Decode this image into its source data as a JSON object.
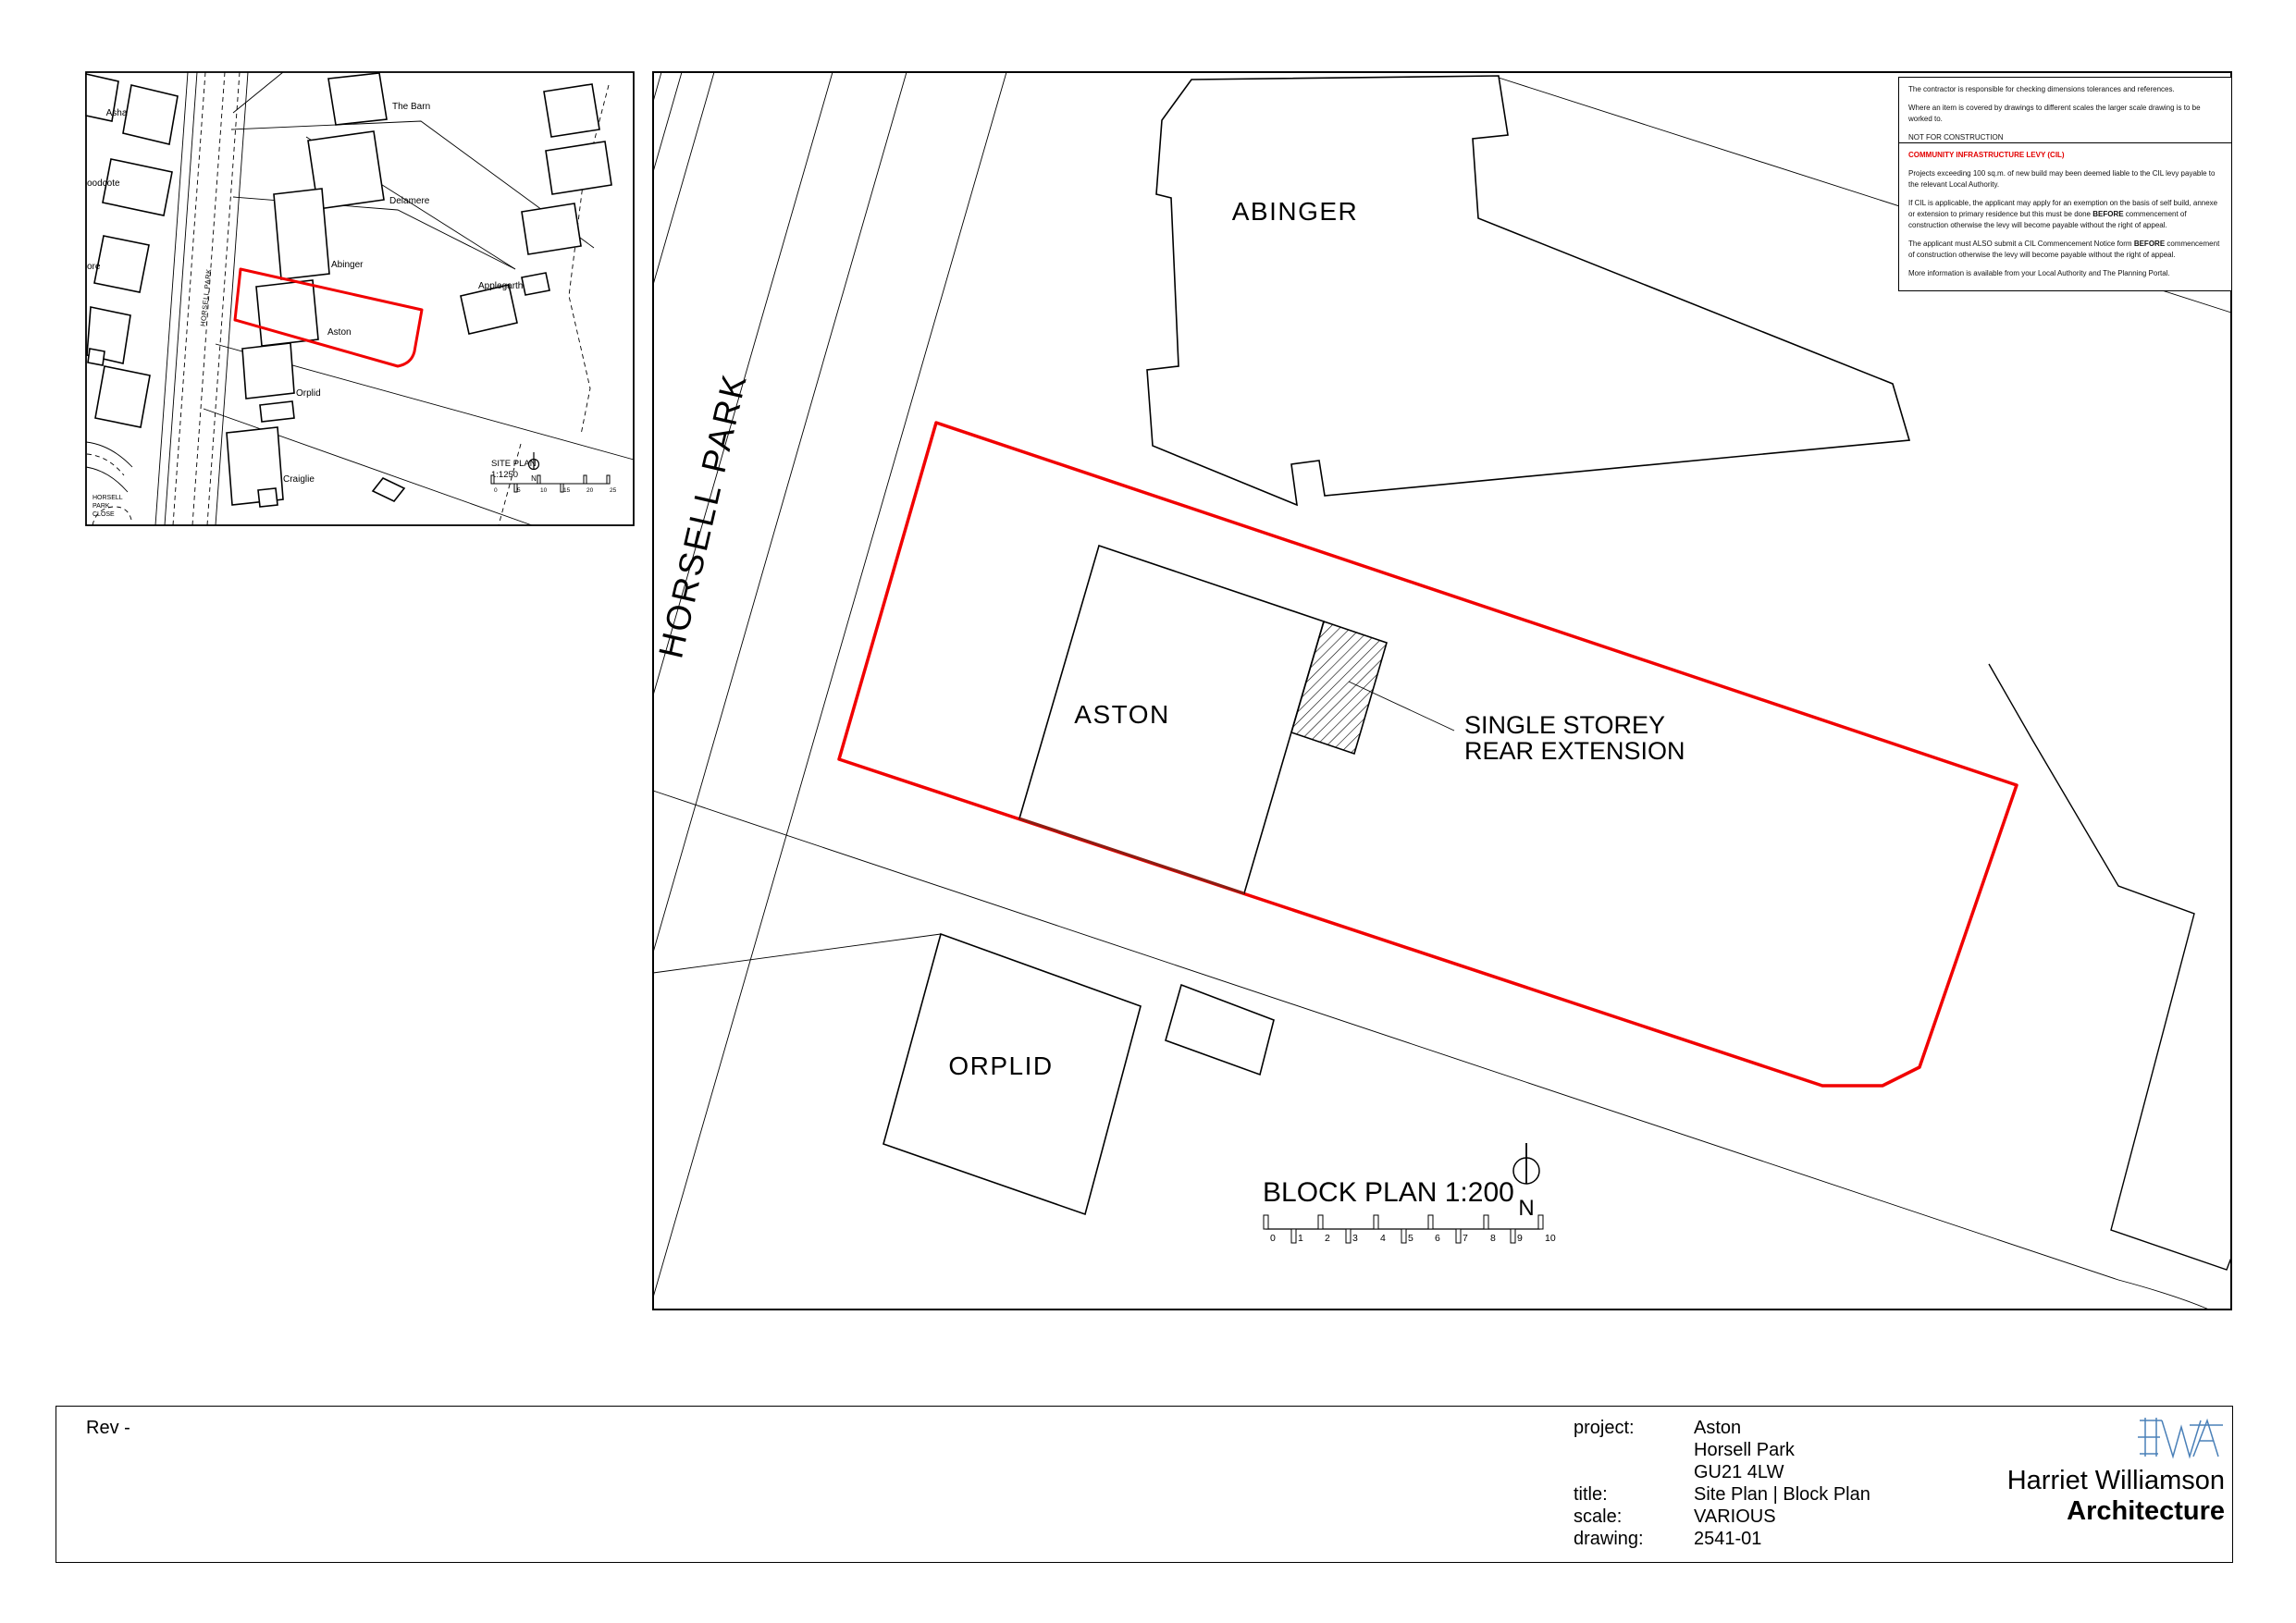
{
  "colors": {
    "boundary_red": "#f10000",
    "overlap_dark_red": "#8c1d12",
    "logo_blue": "#4a80b8",
    "cil_heading_red": "#e30000",
    "line_black": "#000000"
  },
  "site_plan_inset": {
    "title": "SITE PLAN",
    "scale": "1:1250",
    "north_label": "N",
    "road_label": "HORSELL PARK",
    "close_label": [
      "HORSELL",
      "PARK",
      "CLOSE"
    ],
    "scale_ticks": [
      "0",
      "5",
      "10",
      "15",
      "20",
      "25"
    ],
    "labels": {
      "asha": "Asha",
      "the_barn": "The Barn",
      "delamere": "Delamere",
      "woodcote": "oodcote",
      "abinger": "Abinger",
      "ore": "ore",
      "applegarth": "Applegarth",
      "aston": "Aston",
      "orplid": "Orplid",
      "craiglie": "Craiglie"
    }
  },
  "block_plan": {
    "title": "BLOCK PLAN 1:200",
    "north_label": "N",
    "road_label": "HORSELL PARK",
    "scale_ticks": [
      "0",
      "1",
      "2",
      "3",
      "4",
      "5",
      "6",
      "7",
      "8",
      "9",
      "10"
    ],
    "labels": {
      "abinger": "ABINGER",
      "aston": "ASTON",
      "orplid": "ORPLID"
    },
    "annotation": {
      "line1": "SINGLE STOREY",
      "line2": "REAR EXTENSION"
    }
  },
  "notes": {
    "general": [
      "The contractor is responsible for checking dimensions tolerances and references.",
      "Where an item is covered by drawings to different scales the larger scale drawing is to be worked to.",
      "NOT FOR CONSTRUCTION"
    ],
    "cil": {
      "heading": "COMMUNITY INFRASTRUCTURE LEVY (CIL)",
      "p1": "Projects exceeding 100 sq.m. of new build may been deemed liable to the CIL levy payable to the relevant Local Authority.",
      "p2_pre": "If CIL is applicable, the applicant may apply for an exemption on the basis of self build, annexe or extension to primary residence but this must be done ",
      "p2_bold": "BEFORE",
      "p2_post": " commencement of construction otherwise the levy will become payable without the right of appeal.",
      "p3_pre": "The applicant must ALSO submit a CIL Commencement Notice form ",
      "p3_bold": "BEFORE",
      "p3_post": " commencement of construction otherwise the levy will become payable without the right of appeal.",
      "p4": "More information is available from your Local Authority and The Planning Portal."
    }
  },
  "title_block": {
    "rev": "Rev -",
    "project_label": "project:",
    "project_lines": [
      "Aston",
      "Horsell Park",
      "GU21 4LW"
    ],
    "title_label": "title:",
    "title_value": "Site Plan | Block Plan",
    "scale_label": "scale:",
    "scale_value": "VARIOUS",
    "drawing_label": "drawing:",
    "drawing_value": "2541-01",
    "firm_name": "Harriet Williamson",
    "firm_discipline": "Architecture",
    "logo_letters": "HWA"
  }
}
